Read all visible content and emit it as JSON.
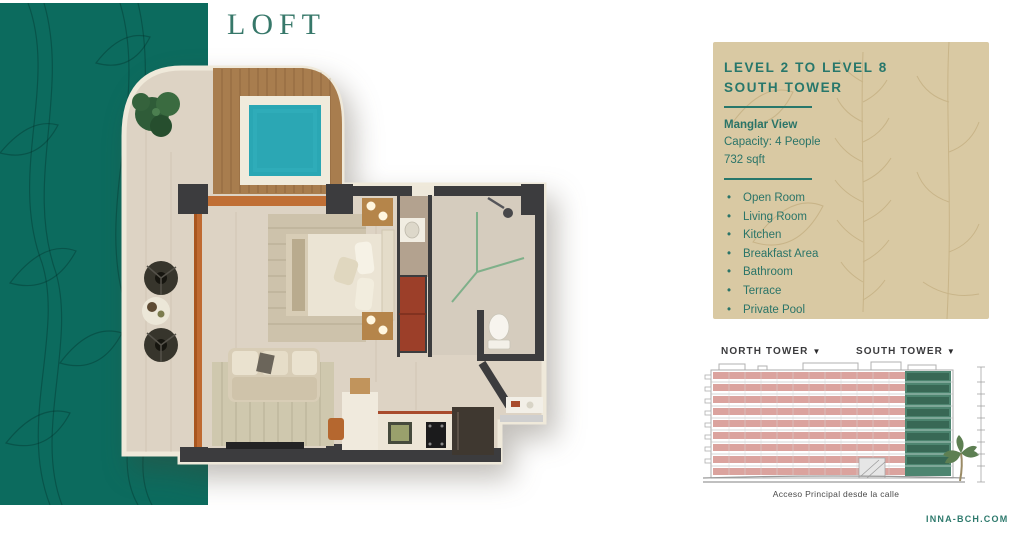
{
  "title": "LOFT",
  "info_panel": {
    "level_range": "LEVEL 2 TO LEVEL 8",
    "tower": "SOUTH TOWER",
    "view_name": "Manglar View",
    "capacity": "Capacity: 4 People",
    "area": "732 sqft",
    "bullet": "•",
    "features": [
      "Open Room",
      "Living Room",
      "Kitchen",
      "Breakfast Area",
      "Bathroom",
      "Terrace",
      "Private Pool"
    ]
  },
  "elevation": {
    "north_tower_label": "NORTH TOWER",
    "south_tower_label": "SOUTH TOWER",
    "marker": "▼",
    "caption": "Acceso Principal desde la calle",
    "floors_visible": 9,
    "north_band_color": "#dba39e",
    "south_block_color": "#4d8570"
  },
  "footer": {
    "website": "INNA-BCH.COM"
  },
  "colors": {
    "accent_teal": "#0c6b5e",
    "text_teal": "#27776b",
    "panel_tan": "#d9c9a3",
    "pool_water": "#2aa7b4",
    "deck_wood": "#a87d4e",
    "partition_orange": "#c06a31",
    "wall_dark": "#3c3c3e",
    "wardrobe_red": "#9c3f29"
  }
}
